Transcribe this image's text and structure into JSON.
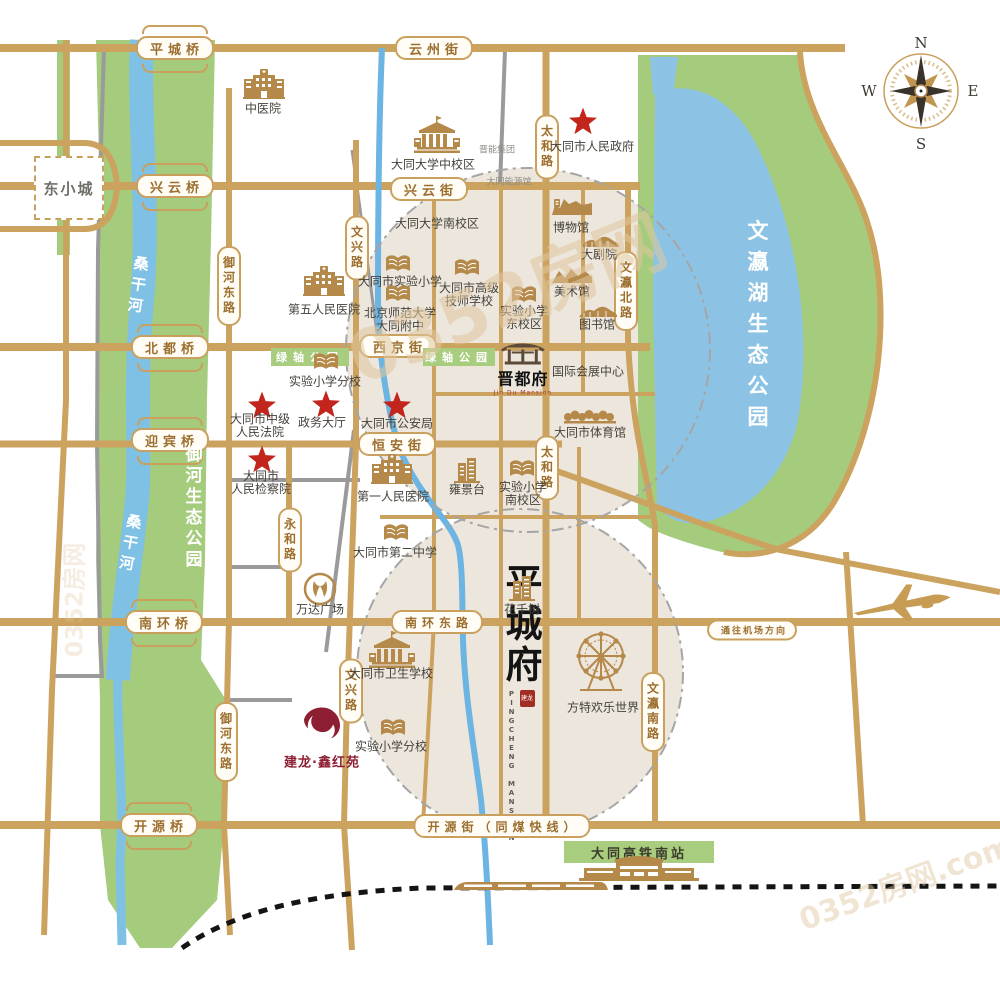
{
  "compass": {
    "n": "N",
    "e": "E",
    "s": "S",
    "w": "W"
  },
  "project": {
    "chars": "平城府",
    "en": "PINGCHENG MANSION",
    "seal": "建龙",
    "x": 521,
    "y": 700
  },
  "jindufu": {
    "name": "晋都府",
    "en": "Jin Du Mansion",
    "x": 523,
    "y": 369
  },
  "jianlong": {
    "text": "建龙·鑫红苑",
    "x": 322,
    "y": 738
  },
  "dongxiaocheng": {
    "text": "东小城",
    "x": 69,
    "y": 188
  },
  "bridges": [
    {
      "id": "bridge-pingcheng",
      "label": "平城桥",
      "x": 175,
      "y": 48
    },
    {
      "id": "bridge-xingyun",
      "label": "兴云桥",
      "x": 175,
      "y": 186
    },
    {
      "id": "bridge-beidu",
      "label": "北都桥",
      "x": 170,
      "y": 347
    },
    {
      "id": "bridge-yingbin",
      "label": "迎宾桥",
      "x": 170,
      "y": 440
    },
    {
      "id": "bridge-nanhuan",
      "label": "南环桥",
      "x": 164,
      "y": 622
    },
    {
      "id": "bridge-kaiyuan",
      "label": "开源桥",
      "x": 159,
      "y": 825
    }
  ],
  "streets_h": [
    {
      "id": "street-yunzhou",
      "label": "云州街",
      "x": 434,
      "y": 48,
      "fs": 13
    },
    {
      "id": "street-xingyun",
      "label": "兴云街",
      "x": 429,
      "y": 189,
      "fs": 13
    },
    {
      "id": "street-xijing",
      "label": "西京街",
      "x": 398,
      "y": 346,
      "fs": 13
    },
    {
      "id": "street-hengan",
      "label": "恒安街",
      "x": 397,
      "y": 444,
      "fs": 13
    },
    {
      "id": "street-nanhuandong",
      "label": "南环东路",
      "x": 437,
      "y": 622,
      "fs": 12
    },
    {
      "id": "street-kaiyuan",
      "label": "开源街（同煤快线）",
      "x": 502,
      "y": 826,
      "fs": 12
    },
    {
      "id": "street-airport",
      "label": "通往机场方向",
      "x": 752,
      "y": 630,
      "fs": 9
    }
  ],
  "streets_v": [
    {
      "id": "road-taihe-n",
      "label": "太和路",
      "x": 547,
      "y": 147
    },
    {
      "id": "road-taihe-s",
      "label": "太和路",
      "x": 547,
      "y": 468
    },
    {
      "id": "road-wenxing-n",
      "label": "文兴路",
      "x": 357,
      "y": 248
    },
    {
      "id": "road-wenxing-s",
      "label": "文兴路",
      "x": 351,
      "y": 691
    },
    {
      "id": "road-yuhedong-n",
      "label": "御河东路",
      "x": 229,
      "y": 286
    },
    {
      "id": "road-yuhedong-s",
      "label": "御河东路",
      "x": 226,
      "y": 742
    },
    {
      "id": "road-yonghe",
      "label": "永和路",
      "x": 290,
      "y": 540
    },
    {
      "id": "road-wenyingbei",
      "label": "文瀛北路",
      "x": 626,
      "y": 291
    },
    {
      "id": "road-wenyingnan",
      "label": "文瀛南路",
      "x": 653,
      "y": 712
    }
  ],
  "parks_labels": [
    {
      "id": "yuhe-park-label",
      "text": "御河生态公园",
      "x": 192,
      "y": 508,
      "fs": 17,
      "rot": 0,
      "ls": 4
    },
    {
      "id": "sanggan-river-label-north",
      "text": "桑干河",
      "x": 138,
      "y": 287,
      "fs": 15,
      "rot": 8,
      "ls": 6
    },
    {
      "id": "sanggan-river-label-south",
      "text": "桑干河",
      "x": 130,
      "y": 545,
      "fs": 15,
      "rot": 10,
      "ls": 6
    },
    {
      "id": "wenying-lake-park-label",
      "text": "文瀛湖生态公园",
      "x": 757,
      "y": 328,
      "fs": 21,
      "rot": 0,
      "ls": 10
    }
  ],
  "green_bands": [
    {
      "id": "green-axis-park-west",
      "text": "绿轴公园",
      "x": 310,
      "y": 348,
      "w": 78,
      "h": 18,
      "dark": false
    },
    {
      "id": "green-axis-park-east",
      "text": "绿轴公园",
      "x": 459,
      "y": 348,
      "w": 72,
      "h": 18,
      "dark": false
    },
    {
      "id": "hsr-station-band",
      "text": "大同高铁南站",
      "x": 639,
      "y": 841,
      "w": 150,
      "h": 22,
      "dark": true
    }
  ],
  "small_labels": [
    {
      "id": "jinneng-group",
      "text": "晋能集团",
      "x": 497,
      "y": 149
    },
    {
      "id": "datong-energy-hall",
      "text": "大同能源馆",
      "x": 509,
      "y": 181
    }
  ],
  "landmarks": [
    {
      "id": "tcm-hospital",
      "icon": "hospital",
      "ix": 264,
      "iy": 84,
      "lines": [
        "中医院"
      ],
      "lx": 263,
      "ly": 109
    },
    {
      "id": "datong-univ-mid-campus",
      "icon": "univ",
      "ix": 437,
      "iy": 135,
      "lines": [
        "大同大学中校区"
      ],
      "lx": 433,
      "ly": 165
    },
    {
      "id": "city-government",
      "icon": "star",
      "ix": 583,
      "iy": 121,
      "lines": [
        "大同市人民政府"
      ],
      "lx": 592,
      "ly": 147
    },
    {
      "id": "datong-univ-south-campus",
      "lines": [
        "大同大学南校区"
      ],
      "lx": 437,
      "ly": 224
    },
    {
      "id": "museum",
      "icon": "museum",
      "ix": 572,
      "iy": 206,
      "lines": [
        "博物馆"
      ],
      "lx": 571,
      "ly": 228
    },
    {
      "id": "grand-theater",
      "icon": "pavilion",
      "ix": 600,
      "iy": 241,
      "lines": [
        "大剧院"
      ],
      "lx": 599,
      "ly": 255
    },
    {
      "id": "art-museum",
      "icon": "art",
      "ix": 572,
      "iy": 276,
      "lines": [
        "美术馆"
      ],
      "lx": 572,
      "ly": 292
    },
    {
      "id": "library",
      "icon": "pavilion",
      "ix": 598,
      "iy": 311,
      "lines": [
        "图书馆"
      ],
      "lx": 597,
      "ly": 325
    },
    {
      "id": "fifth-peoples-hospital",
      "icon": "hospital",
      "ix": 324,
      "iy": 281,
      "lines": [
        "第五人民医院"
      ],
      "lx": 324,
      "ly": 310
    },
    {
      "id": "exp-primary-school",
      "icon": "book",
      "ix": 398,
      "iy": 264,
      "lines": [
        "大同市实验小学"
      ],
      "lx": 400,
      "ly": 282
    },
    {
      "id": "senior-technician-school",
      "icon": "book",
      "ix": 467,
      "iy": 268,
      "lines": [
        "大同市高级",
        "技师学校"
      ],
      "lx": 469,
      "ly": 295
    },
    {
      "id": "exp-primary-east-campus",
      "icon": "book",
      "ix": 524,
      "iy": 295,
      "lines": [
        "实验小学",
        "东校区"
      ],
      "lx": 524,
      "ly": 318
    },
    {
      "id": "bnu-datong-affiliated",
      "icon": "book",
      "ix": 398,
      "iy": 294,
      "lines": [
        "北京师范大学",
        "大同附中"
      ],
      "lx": 400,
      "ly": 320
    },
    {
      "id": "exp-primary-branch-north",
      "icon": "book",
      "ix": 326,
      "iy": 362,
      "lines": [
        "实验小学分校"
      ],
      "lx": 325,
      "ly": 382
    },
    {
      "id": "intermediate-court",
      "icon": "star",
      "ix": 262,
      "iy": 405,
      "lines": [
        "大同市中级",
        "人民法院"
      ],
      "lx": 260,
      "ly": 426
    },
    {
      "id": "government-hall",
      "icon": "star",
      "ix": 326,
      "iy": 404,
      "lines": [
        "政务大厅"
      ],
      "lx": 322,
      "ly": 423
    },
    {
      "id": "public-security-bureau",
      "icon": "star",
      "ix": 397,
      "iy": 405,
      "lines": [
        "大同市公安局"
      ],
      "lx": 397,
      "ly": 424
    },
    {
      "id": "peoples-procuratorate",
      "icon": "star",
      "ix": 262,
      "iy": 459,
      "lines": [
        "大同市",
        "人民检察院"
      ],
      "lx": 261,
      "ly": 483
    },
    {
      "id": "intl-expo-center",
      "lines": [
        "国际会展中心"
      ],
      "lx": 588,
      "ly": 372
    },
    {
      "id": "city-gymnasium",
      "icon": "trees",
      "ix": 590,
      "iy": 417,
      "lines": [
        "大同市体育馆"
      ],
      "lx": 590,
      "ly": 433
    },
    {
      "id": "first-peoples-hospital",
      "icon": "hospital",
      "ix": 392,
      "iy": 469,
      "lines": [
        "第一人民医院"
      ],
      "lx": 393,
      "ly": 497
    },
    {
      "id": "yongjingtai",
      "icon": "tower",
      "ix": 467,
      "iy": 470,
      "lines": [
        "雍景台"
      ],
      "lx": 467,
      "ly": 490
    },
    {
      "id": "exp-primary-south-campus",
      "icon": "book",
      "ix": 522,
      "iy": 469,
      "lines": [
        "实验小学",
        "南校区"
      ],
      "lx": 523,
      "ly": 494
    },
    {
      "id": "no2-middle-school",
      "icon": "book",
      "ix": 396,
      "iy": 533,
      "lines": [
        "大同市第二中学"
      ],
      "lx": 395,
      "ly": 553
    },
    {
      "id": "wanda-plaza",
      "icon": "wanda",
      "ix": 320,
      "iy": 589,
      "lines": [
        "万达广场"
      ],
      "lx": 320,
      "ly": 610
    },
    {
      "id": "huaqianshu",
      "icon": "tower",
      "ix": 522,
      "iy": 588,
      "lines": [
        "花千树"
      ],
      "lx": 522,
      "ly": 610
    },
    {
      "id": "health-school",
      "icon": "univ",
      "ix": 392,
      "iy": 650,
      "lines": [
        "大同市卫生学校"
      ],
      "lx": 391,
      "ly": 674
    },
    {
      "id": "exp-primary-branch-south",
      "icon": "book",
      "ix": 393,
      "iy": 728,
      "lines": [
        "实验小学分校"
      ],
      "lx": 391,
      "ly": 747
    },
    {
      "id": "fangte-happy-world",
      "icon": "ferris",
      "ix": 601,
      "iy": 663,
      "lines": [
        "方特欢乐世界"
      ],
      "lx": 603,
      "ly": 708
    },
    {
      "id": "hsr-station-building",
      "icon": "station",
      "ix": 639,
      "iy": 867,
      "lines": [],
      "lx": 639,
      "ly": 867
    },
    {
      "id": "hsr-train",
      "icon": "train",
      "ix": 530,
      "iy": 886,
      "lines": [],
      "lx": 530,
      "ly": 886
    },
    {
      "id": "airplane",
      "icon": "plane",
      "ix": 903,
      "iy": 604,
      "lines": [],
      "lx": 903,
      "ly": 604
    }
  ],
  "watermarks": [
    {
      "id": "watermark-center",
      "text": "0352房网",
      "x": 505,
      "y": 295,
      "fs": 70,
      "rot": -22,
      "op": 0.55
    },
    {
      "id": "watermark-bottom-right",
      "text": "0352房网.com",
      "x": 905,
      "y": 880,
      "fs": 30,
      "rot": -20,
      "op": 0.45
    },
    {
      "id": "watermark-left",
      "text": "0352房网",
      "x": 72,
      "y": 600,
      "fs": 24,
      "rot": -90,
      "op": 0.3
    }
  ]
}
